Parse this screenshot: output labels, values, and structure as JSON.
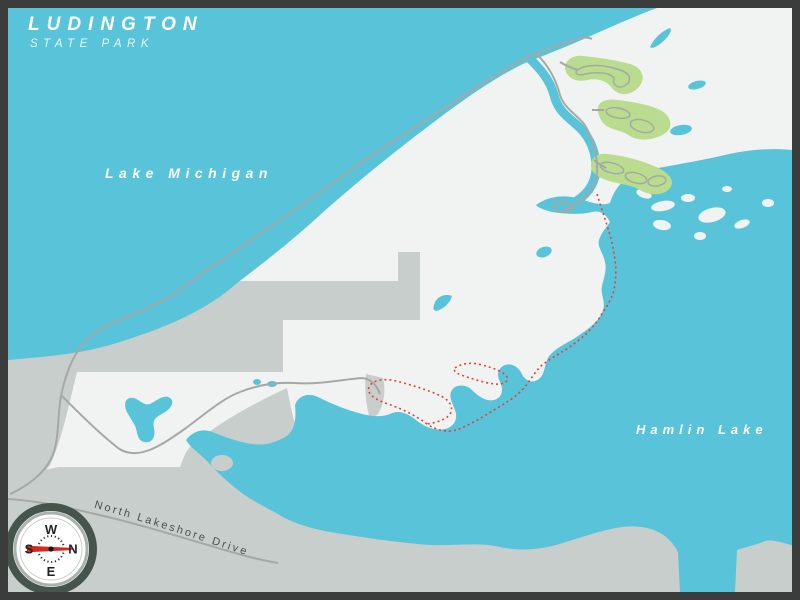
{
  "title": {
    "line1": "LUDINGTON",
    "line2": "STATE PARK"
  },
  "labels": {
    "lake_michigan": "Lake Michigan",
    "hamlin_lake": "Hamlin Lake",
    "road": "North Lakeshore Drive"
  },
  "compass": {
    "top": "W",
    "left": "S",
    "right": "N",
    "bottom": "E"
  },
  "map_features": {
    "water_bodies": [
      "Lake Michigan",
      "Hamlin Lake",
      "Big Sable River"
    ],
    "trail_style": "red-dotted",
    "campground_areas": 3,
    "orientation": "north-points-right"
  },
  "colors": {
    "border": "#3b3d3d",
    "water": "#58c3d9",
    "land": "#f1f3f2",
    "outside_land": "#c8cecb",
    "road": "#a5a9a6",
    "campground": "#b9dc8e",
    "trail": "#e14236",
    "road_text": "#474f4c",
    "compass_ring": "#45544c",
    "needle": "#d6281e"
  }
}
